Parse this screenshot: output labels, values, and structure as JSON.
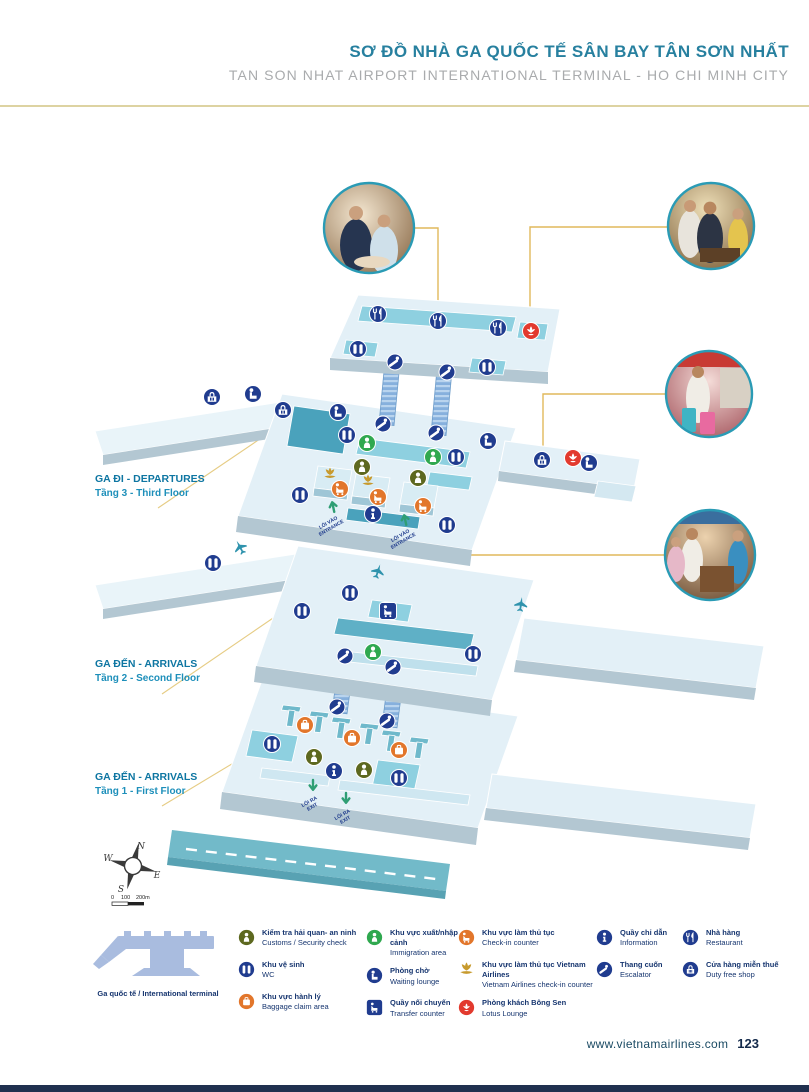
{
  "header": {
    "title_vi": "SƠ ĐỒ NHÀ GA QUỐC TẾ SÂN BAY TÂN SƠN NHẤT",
    "title_en": "TAN SON NHAT AIRPORT INTERNATIONAL TERMINAL - HO CHI MINH CITY"
  },
  "floors": [
    {
      "vi": "GA ĐI - DEPARTURES",
      "en": "Tầng 3 - Third Floor"
    },
    {
      "vi": "GA ĐẾN - ARRIVALS",
      "en": "Tầng 2 - Second Floor"
    },
    {
      "vi": "GA ĐẾN - ARRIVALS",
      "en": "Tầng 1 - First Floor"
    }
  ],
  "map_labels": {
    "entrance_vi": "LỐI VÀO",
    "entrance_en": "ENTRANCE",
    "exit_vi": "LỐI RA",
    "exit_en": "EXIT"
  },
  "compass": {
    "n": "N",
    "w": "W",
    "e": "E",
    "s": "S",
    "scale": [
      "0",
      "100",
      "200m"
    ]
  },
  "legend": {
    "terminal_label": "Ga quốc tế / International terminal",
    "items": [
      {
        "icon": "customs-icon",
        "color": "#5d681f",
        "vi": "Kiểm tra hải quan- an ninh",
        "en": "Customs / Security check"
      },
      {
        "icon": "wc-icon",
        "color": "#203c8f",
        "vi": "Khu vệ sinh",
        "en": "WC"
      },
      {
        "icon": "baggage-icon",
        "color": "#e2762b",
        "vi": "Khu vực hành lý",
        "en": "Baggage claim area"
      },
      {
        "icon": "immigration-icon",
        "color": "#2fa84f",
        "vi": "Khu vực xuất/nhập cảnh",
        "en": "Immigration area"
      },
      {
        "icon": "waiting-lounge-icon",
        "color": "#203c8f",
        "vi": "Phòng chờ",
        "en": "Waiting lounge"
      },
      {
        "icon": "transfer-icon",
        "color": "#203c8f",
        "vi": "Quầy nối chuyến",
        "en": "Transfer counter"
      },
      {
        "icon": "checkin-icon",
        "color": "#e2762b",
        "vi": "Khu vực làm thủ tục",
        "en": "Check-in counter"
      },
      {
        "icon": "vna-checkin-icon",
        "color": "#c79a2d",
        "vi": "Khu vực làm thủ tục Vietnam Airlines",
        "en": "Vietnam Airlines check-in counter"
      },
      {
        "icon": "lotus-lounge-icon",
        "color": "#e23a2e",
        "vi": "Phòng khách Bông Sen",
        "en": "Lotus Lounge"
      },
      {
        "icon": "information-icon",
        "color": "#203c8f",
        "vi": "Quầy chỉ dẫn",
        "en": "Information"
      },
      {
        "icon": "escalator-icon",
        "color": "#203c8f",
        "vi": "Thang cuốn",
        "en": "Escalator"
      },
      {
        "icon": "restaurant-icon",
        "color": "#203c8f",
        "vi": "Nhà hàng",
        "en": "Restaurant"
      },
      {
        "icon": "dutyfree-icon",
        "color": "#203c8f",
        "vi": "Cửa hàng miễn thuế",
        "en": "Duty free shop"
      }
    ]
  },
  "footer": {
    "website": "www.vietnamairlines.com",
    "page": "123"
  },
  "colors": {
    "title_teal": "#27809f",
    "subtitle_gray": "#a9abad",
    "gold_rule": "#ddd3a2",
    "callout_gold": "#e0b95c",
    "navy_icon": "#203c8f",
    "green_icon": "#2fa84f",
    "olive_icon": "#5d681f",
    "orange_icon": "#e2762b",
    "red_icon": "#e23a2e",
    "vna_gold": "#c79a2d",
    "floor_light": "#e3f0f7",
    "floor_side": "#b3c7d2",
    "teal_block": "#8ed0e0",
    "teal_dark": "#4aa2bc",
    "road_teal": "#72bac9",
    "footer_navy": "#12294a"
  }
}
